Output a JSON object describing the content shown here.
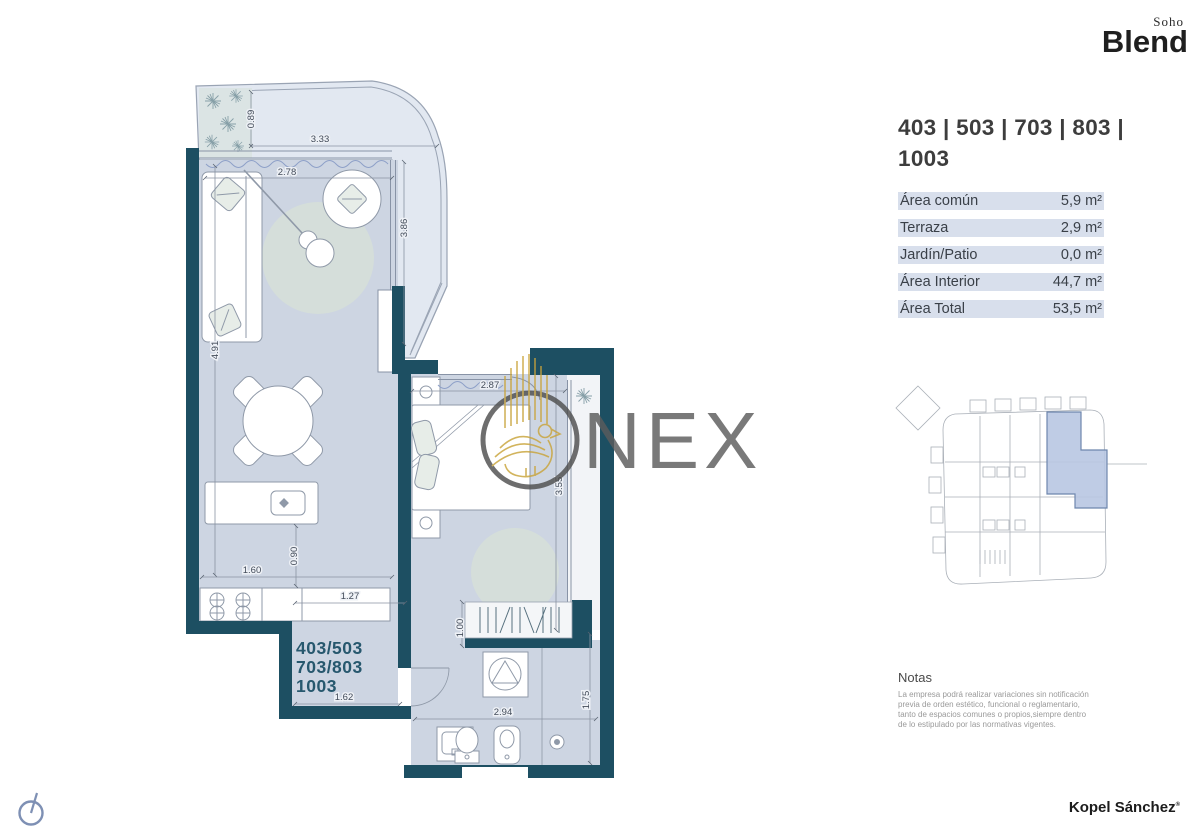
{
  "brand": {
    "name": "Blend",
    "sub": "Soho"
  },
  "unit": {
    "title_line1": "403 | 503 | 703 | 803 |",
    "title_line2": "1003"
  },
  "areas": {
    "rows": [
      {
        "label": "Área común",
        "value": "5,9 m²"
      },
      {
        "label": "Terraza",
        "value": "2,9 m²"
      },
      {
        "label": "Jardín/Patio",
        "value": "0,0 m²"
      },
      {
        "label": "Área Interior",
        "value": "44,7 m²"
      },
      {
        "label": "Área Total",
        "value": "53,5 m²"
      }
    ]
  },
  "notes": {
    "heading": "Notas",
    "body": "La empresa podrá realizar variaciones sin notificación previa de orden estético, funcional o reglamentario, tanto de espacios comunes o propios,siempre dentro de lo estipulado por las normativas vigentes."
  },
  "footer": {
    "name": "Kopel Sánchez",
    "mark": "®"
  },
  "watermark": {
    "text": "NEX"
  },
  "colors": {
    "wall": "#1d4f62",
    "floor": "#cdd5e2",
    "highlight": "#b8c6e2",
    "gold": "#c9a43a"
  },
  "plan": {
    "unit_label": [
      "403/503",
      "703/803",
      "1003"
    ],
    "dims": {
      "terrace_depth": "0.89",
      "terrace_width": "3.33",
      "living_width": "2.78",
      "terrace_side": "3.86",
      "living_length": "4.91",
      "island_gap": "0.90",
      "kitchen_width": "1.60",
      "hall_width": "1.27",
      "closet_depth": "1.00",
      "bedroom_width": "2.87",
      "bedroom_length": "3.55",
      "entry_width": "1.62",
      "bath_width": "2.94",
      "bath_depth": "1.75"
    }
  }
}
